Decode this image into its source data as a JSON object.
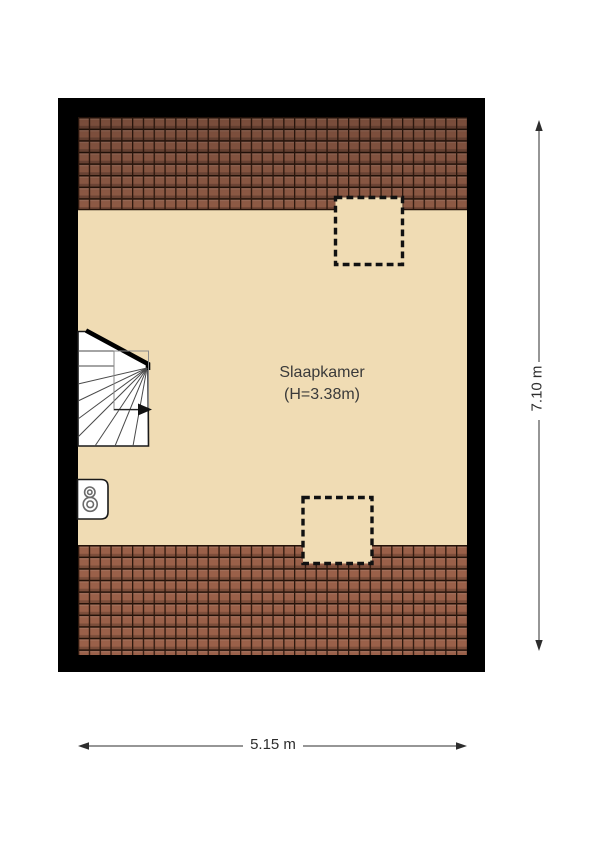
{
  "room": {
    "name": "Slaapkamer",
    "height_label": "(H=3.38m)"
  },
  "dimensions": {
    "width": "5.15 m",
    "height": "7.10 m"
  },
  "colors": {
    "background": "#ffffff",
    "wall": "#000000",
    "floor": "#f0dcb4",
    "roof_tile_top": "#8e5a45",
    "roof_tile_bottom": "#9a6049",
    "tile_seam": "#241209",
    "stair_fill": "#ffffff",
    "dimension_text": "#2d2d2d"
  },
  "icons": {
    "staircase": "winder-staircase-with-direction-arrow",
    "boiler": "boiler-unit",
    "skylight_top": "dashed-roof-window",
    "skylight_bottom": "dashed-roof-window"
  }
}
